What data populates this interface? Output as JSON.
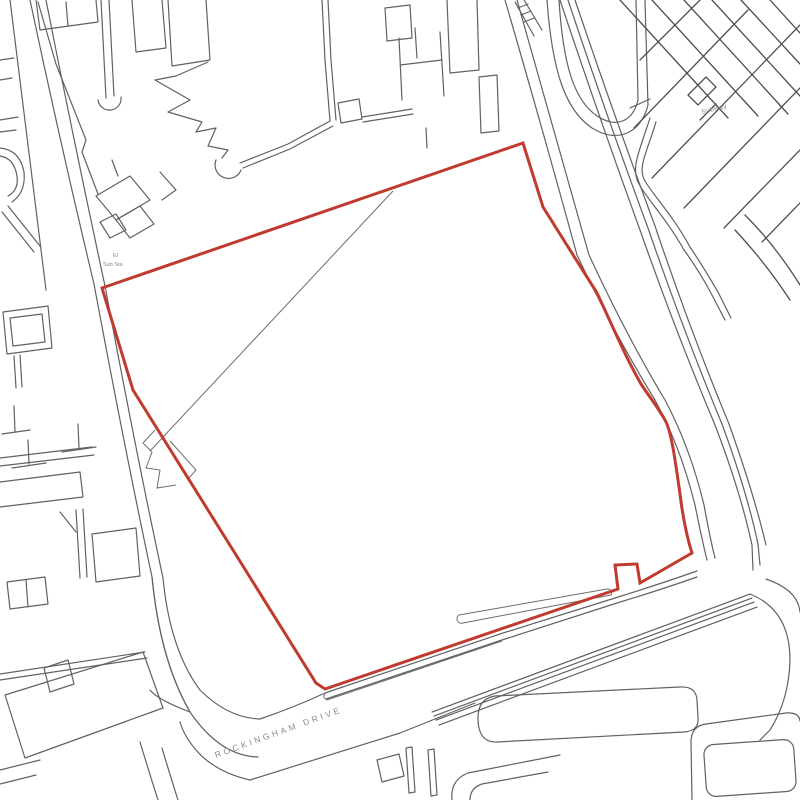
{
  "map": {
    "labels": {
      "street_name": "ROCKINGHAM DRIVE",
      "subway": "Subway",
      "substation_line1": "El",
      "substation_line2": "Sub Sta"
    },
    "colors": {
      "background": "#ffffff",
      "site_boundary_red": "#c03a30",
      "linework_gray": "#5f5f5f",
      "label_gray": "#8c8c8c"
    },
    "site_boundary": {
      "stroke_width_px": 3
    }
  }
}
